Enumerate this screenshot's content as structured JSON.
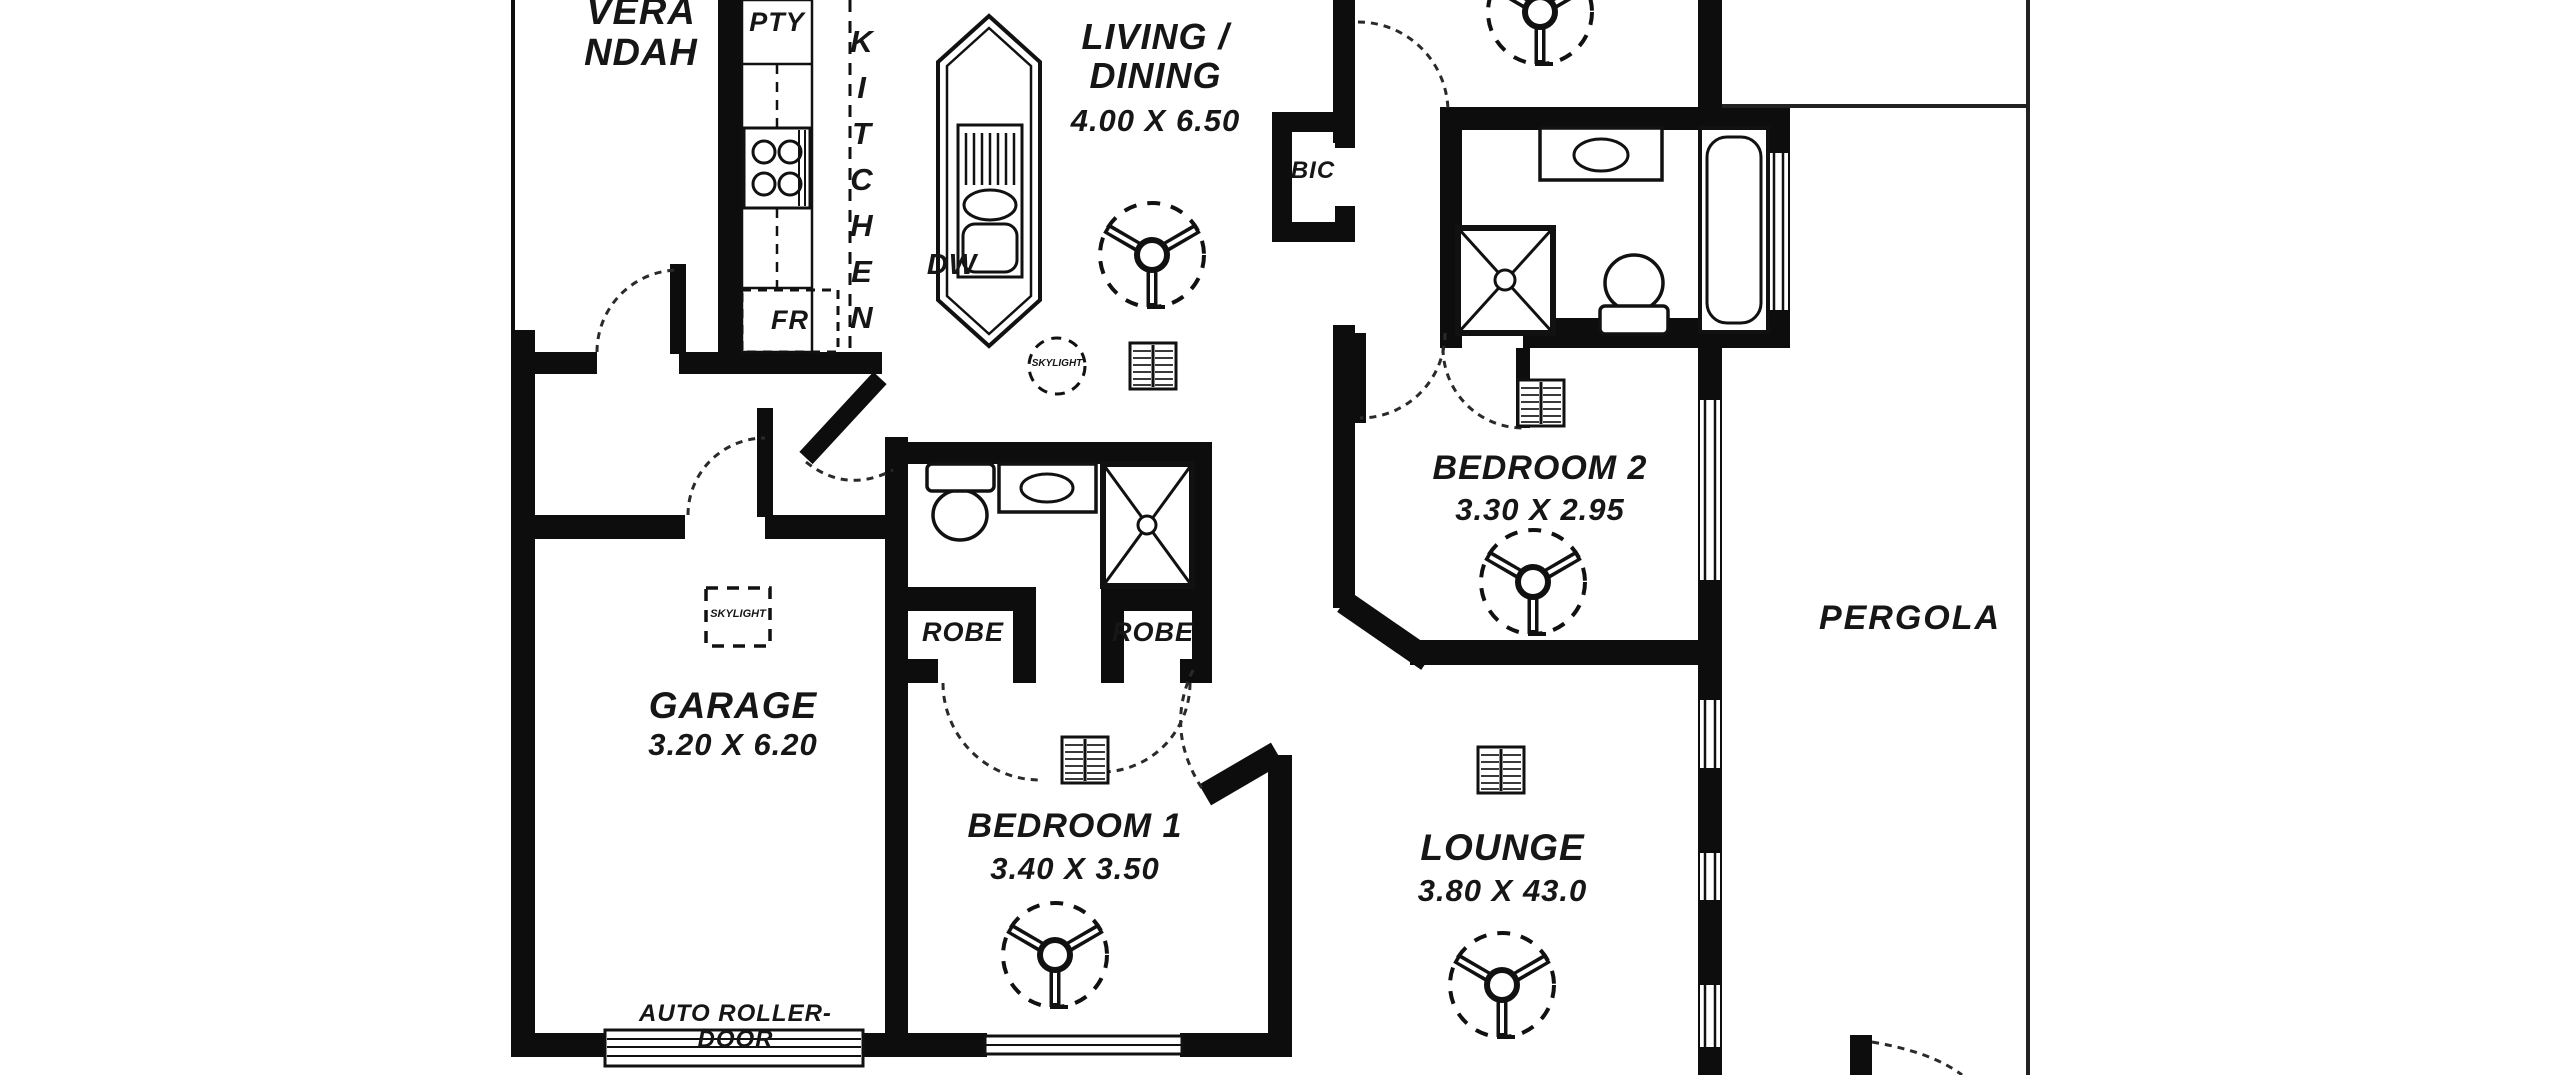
{
  "colors": {
    "ink": "#111111",
    "background": "#ffffff"
  },
  "rooms": {
    "verandah": {
      "label": "VERA NDAH"
    },
    "kitchen": {
      "label": "KITCHEN"
    },
    "living_dining": {
      "line1": "LIVING /",
      "line2": "DINING",
      "dims": "4.00 X 6.50"
    },
    "garage": {
      "label": "GARAGE",
      "dims": "3.20 X 6.20"
    },
    "bedroom1": {
      "label": "BEDROOM 1",
      "dims": "3.40 X 3.50"
    },
    "bedroom2": {
      "label": "BEDROOM 2",
      "dims": "3.30 X 2.95"
    },
    "lounge": {
      "label": "LOUNGE",
      "dims": "3.80 X 43.0"
    },
    "pergola": {
      "label": "PERGOLA"
    }
  },
  "fixtures": {
    "pantry": "PTY",
    "fridge": "FR",
    "dishwasher": "DW",
    "built_in_cupboard": "BIC",
    "robe_left": "ROBE",
    "robe_right": "ROBE",
    "skylight_garage": "SKYLIGHT",
    "skylight_living": "SKYLIGHT",
    "auto_roller_door": "AUTO ROLLER-DOOR"
  }
}
